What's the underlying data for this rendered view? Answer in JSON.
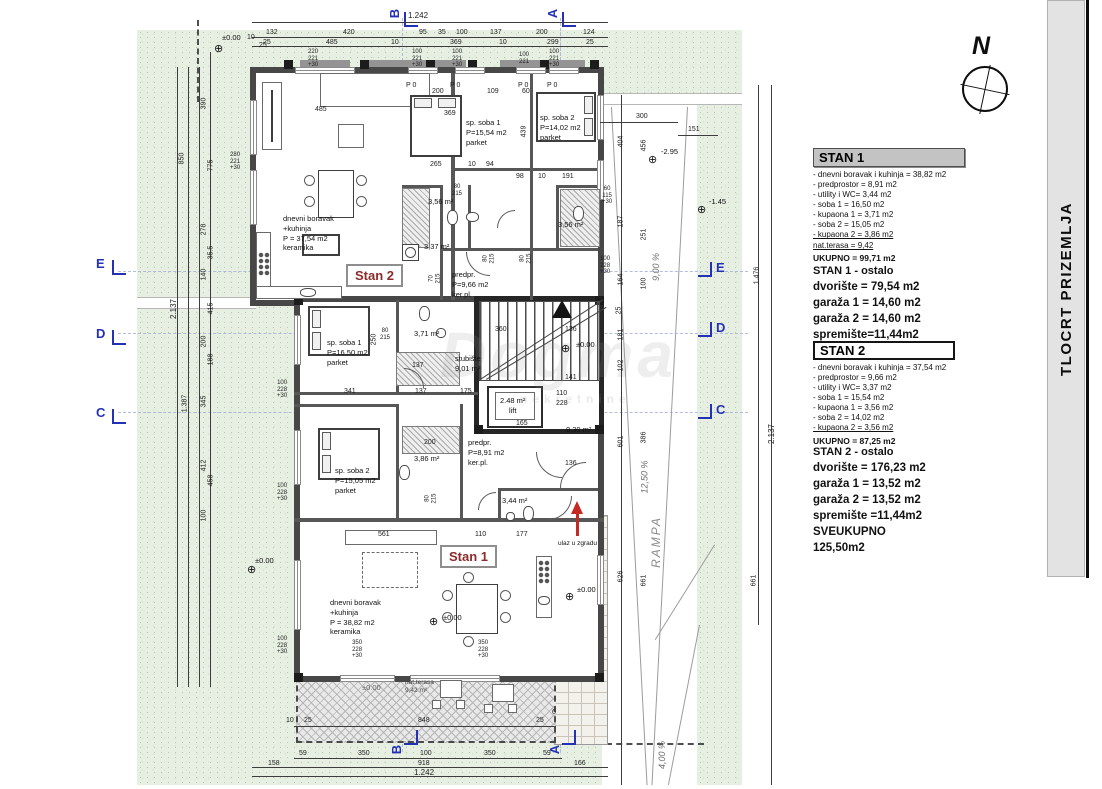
{
  "title": "TLOCRT PRIZEMLJA",
  "compass": {
    "label": "N"
  },
  "watermark": {
    "main": "Dogma",
    "sub": "nekretnine"
  },
  "panel": {
    "stan1": {
      "title": "STAN 1",
      "items": [
        "- dnevni boravak i kuhinja = 38,82 m2",
        "- predprostor = 8,91 m2",
        "- utility i WC= 3,44 m2",
        "- soba 1 = 16,50 m2",
        "- kupaona 1 = 3,71 m2",
        "- soba 2 = 15,05 m2",
        "- kupaona 2 = 3,86 m2",
        "nat.terasa  = 9,42"
      ],
      "ukupno": "UKUPNO = 99,71 m2",
      "ostalo_title": "STAN 1 - ostalo",
      "ostalo": [
        "dvorište = 79,54 m2",
        "garaža 1 = 14,60 m2",
        "garaža 2 = 14,60 m2",
        "spremište=11,44m2",
        "SVEUKUPNO 129,03m2"
      ]
    },
    "stan2": {
      "title": "STAN 2",
      "items": [
        "- dnevni boravak i kuhinja = 37,54 m2",
        "- predprostor = 9,66 m2",
        "- utility i WC= 3,37 m2",
        "- soba 1 = 15,54 m2",
        "- kupaona 1 = 3,56 m2",
        "- soba 2 = 14,02 m2",
        "- kupaona 2 = 3,56 m2"
      ],
      "ukupno": "UKUPNO = 87,25 m2",
      "ostalo_title": "STAN 2 - ostalo",
      "ostalo": [
        "dvorište = 176,23 m2",
        "garaža 1 = 13,52 m2",
        "garaža 2 = 13,52 m2",
        "spremište =11,44m2",
        "SVEUKUPNO",
        "125,50m2"
      ]
    }
  },
  "plan": {
    "labels": {
      "stan1": "Stan 1",
      "stan2": "Stan 2"
    },
    "rooms": {
      "living2": [
        "dnevni boravak",
        "+kuhinja",
        "P = 37,54 m2",
        "keramika"
      ],
      "bed2_1": [
        "sp. soba 1",
        "P=15,54 m2",
        "parket"
      ],
      "bed2_2": [
        "sp. soba 2",
        "P=14,02 m2",
        "parket"
      ],
      "bath2_1": "3,56 m²",
      "bath2_2": "3,56 m²",
      "util2": "3,37 m²",
      "pred2": [
        "predpr.",
        "P=9,66 m2",
        "ker.pl."
      ],
      "bed1_1": [
        "sp. soba 1",
        "P=16,50 m2",
        "parket"
      ],
      "bath1_1": "3,71 m²",
      "stairs": [
        "stubište",
        "9,01 m²"
      ],
      "lift": [
        "2.48 m²",
        "lift"
      ],
      "area830": "8,30 m²",
      "pred1": [
        "predpr.",
        "P=8,91 m2",
        "ker.pl."
      ],
      "bed1_2": [
        "sp. soba 2",
        "P=15,05 m2",
        "parket"
      ],
      "bath1_2": "3,86 m²",
      "wc1": "3,44 m²",
      "living1": [
        "dnevni boravak",
        "+kuhinja",
        "P = 38,82 m2",
        "keramika"
      ],
      "terrace": [
        "nat.terasa",
        "9,42 m²"
      ]
    },
    "ann": {
      "rampa": "RAMPA",
      "s125": "12,50 %",
      "s900": "9,00 %",
      "s400": "4,00 %",
      "ulaz": "ulaz u zgradu",
      "lvl0": "±0.00",
      "lvl295": "-2.95",
      "lvl145": "-1.45"
    },
    "sections": {
      "a": "A",
      "b": "B",
      "c": "C",
      "d": "D",
      "e": "E"
    },
    "dims": {
      "top_total": "1.242",
      "t1": [
        "132",
        "420",
        "95",
        "35",
        "100",
        "137",
        "200",
        "124"
      ],
      "t2": [
        "25",
        "485",
        "10",
        "369",
        "10",
        "299",
        "25"
      ],
      "c10": "10",
      "c25": "25",
      "b0": [
        "10",
        "25",
        "848",
        "25",
        "6"
      ],
      "b1": [
        "59",
        "350",
        "100",
        "350",
        "59"
      ],
      "b2": [
        "158",
        "918",
        "166"
      ],
      "bottom_total": "1.242",
      "left_outer": [
        "850",
        "2.137",
        "1.387"
      ],
      "left_chain": [
        "390",
        "775",
        "278",
        "35.5",
        "140",
        "415",
        "200",
        "188",
        "345",
        "412",
        "458",
        "100"
      ],
      "right_outer": [
        "1.476",
        "2.137",
        "661"
      ],
      "rc1": [
        "404",
        "187",
        "164",
        "25",
        "181",
        "102",
        "601",
        "626"
      ],
      "rc2": [
        "456",
        "251",
        "100",
        "386",
        "661"
      ],
      "rh": [
        "300",
        "151"
      ],
      "wstacks": [
        [
          "220",
          "221",
          "+30"
        ],
        [
          "100",
          "221",
          "+30"
        ],
        [
          "100",
          "221",
          "+30"
        ],
        [
          "100",
          "221"
        ],
        [
          "100",
          "221",
          "+30"
        ]
      ],
      "lstack": [
        "280",
        "221",
        "+30"
      ],
      "wallstack": [
        "100",
        "228",
        "+30"
      ],
      "fstack": [
        "350",
        "228",
        "+30"
      ],
      "rstack1": [
        "60",
        "115",
        "+30"
      ],
      "rstack2": [
        "100",
        "228",
        "+30"
      ],
      "dstack80": [
        "80",
        "215"
      ],
      "dstack70": [
        "70",
        "215"
      ],
      "inner": {
        "d485": "485",
        "d369": "369",
        "d200": "200",
        "d109": "109",
        "d60": "60",
        "p0": "P 0",
        "d265": "265",
        "d10a": "10",
        "d94": "94",
        "d98": "98",
        "d191": "191",
        "d439": "439",
        "d341": "341",
        "d137": "137",
        "d175": "175",
        "d250": "250",
        "d360": "360",
        "d136": "136",
        "d141": "141",
        "d165": "165",
        "d110": "110",
        "d228": "228",
        "d561": "561",
        "d177": "177"
      }
    }
  }
}
